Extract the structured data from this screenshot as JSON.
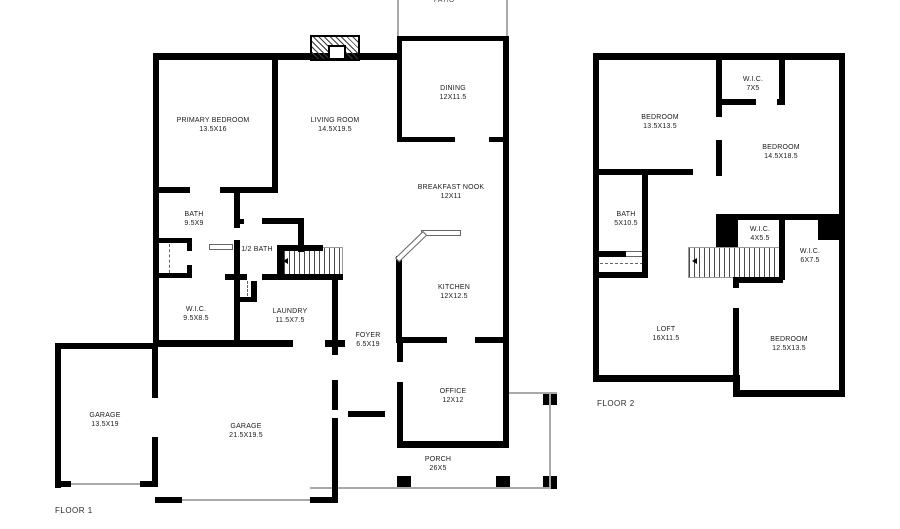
{
  "plan": {
    "background_color": "#ffffff",
    "wall_color": "#000000",
    "window_border_color": "#8a8a8a",
    "porch_line_color": "#a9a9a9"
  },
  "floor1": {
    "caption": "FLOOR 1",
    "patio_label_partial": "PATIO",
    "rooms": [
      {
        "name": "PRIMARY BEDROOM",
        "dims": "13.5X16"
      },
      {
        "name": "LIVING ROOM",
        "dims": "14.5X19.5"
      },
      {
        "name": "DINING",
        "dims": "12X11.5"
      },
      {
        "name": "BREAKFAST NOOK",
        "dims": "12X11"
      },
      {
        "name": "KITCHEN",
        "dims": "12X12.5"
      },
      {
        "name": "BATH",
        "dims": "9.5X9"
      },
      {
        "name": "1/2 BATH",
        "dims": ""
      },
      {
        "name": "W.I.C.",
        "dims": "9.5X8.5"
      },
      {
        "name": "LAUNDRY",
        "dims": "11.5X7.5"
      },
      {
        "name": "FOYER",
        "dims": "6.5X19"
      },
      {
        "name": "OFFICE",
        "dims": "12X12"
      },
      {
        "name": "GARAGE",
        "dims": "13.5X19"
      },
      {
        "name": "GARAGE",
        "dims": "21.5X19.5"
      },
      {
        "name": "PORCH",
        "dims": "26X5"
      }
    ]
  },
  "floor2": {
    "caption": "FLOOR 2",
    "rooms": [
      {
        "name": "BEDROOM",
        "dims": "13.5X13.5"
      },
      {
        "name": "W.I.C.",
        "dims": "7X5"
      },
      {
        "name": "BEDROOM",
        "dims": "14.5X18.5"
      },
      {
        "name": "BATH",
        "dims": "5X10.5"
      },
      {
        "name": "W.I.C.",
        "dims": "4X5.5"
      },
      {
        "name": "W.I.C.",
        "dims": "6X7.5"
      },
      {
        "name": "LOFT",
        "dims": "16X11.5"
      },
      {
        "name": "BEDROOM",
        "dims": "12.5X13.5"
      }
    ]
  }
}
